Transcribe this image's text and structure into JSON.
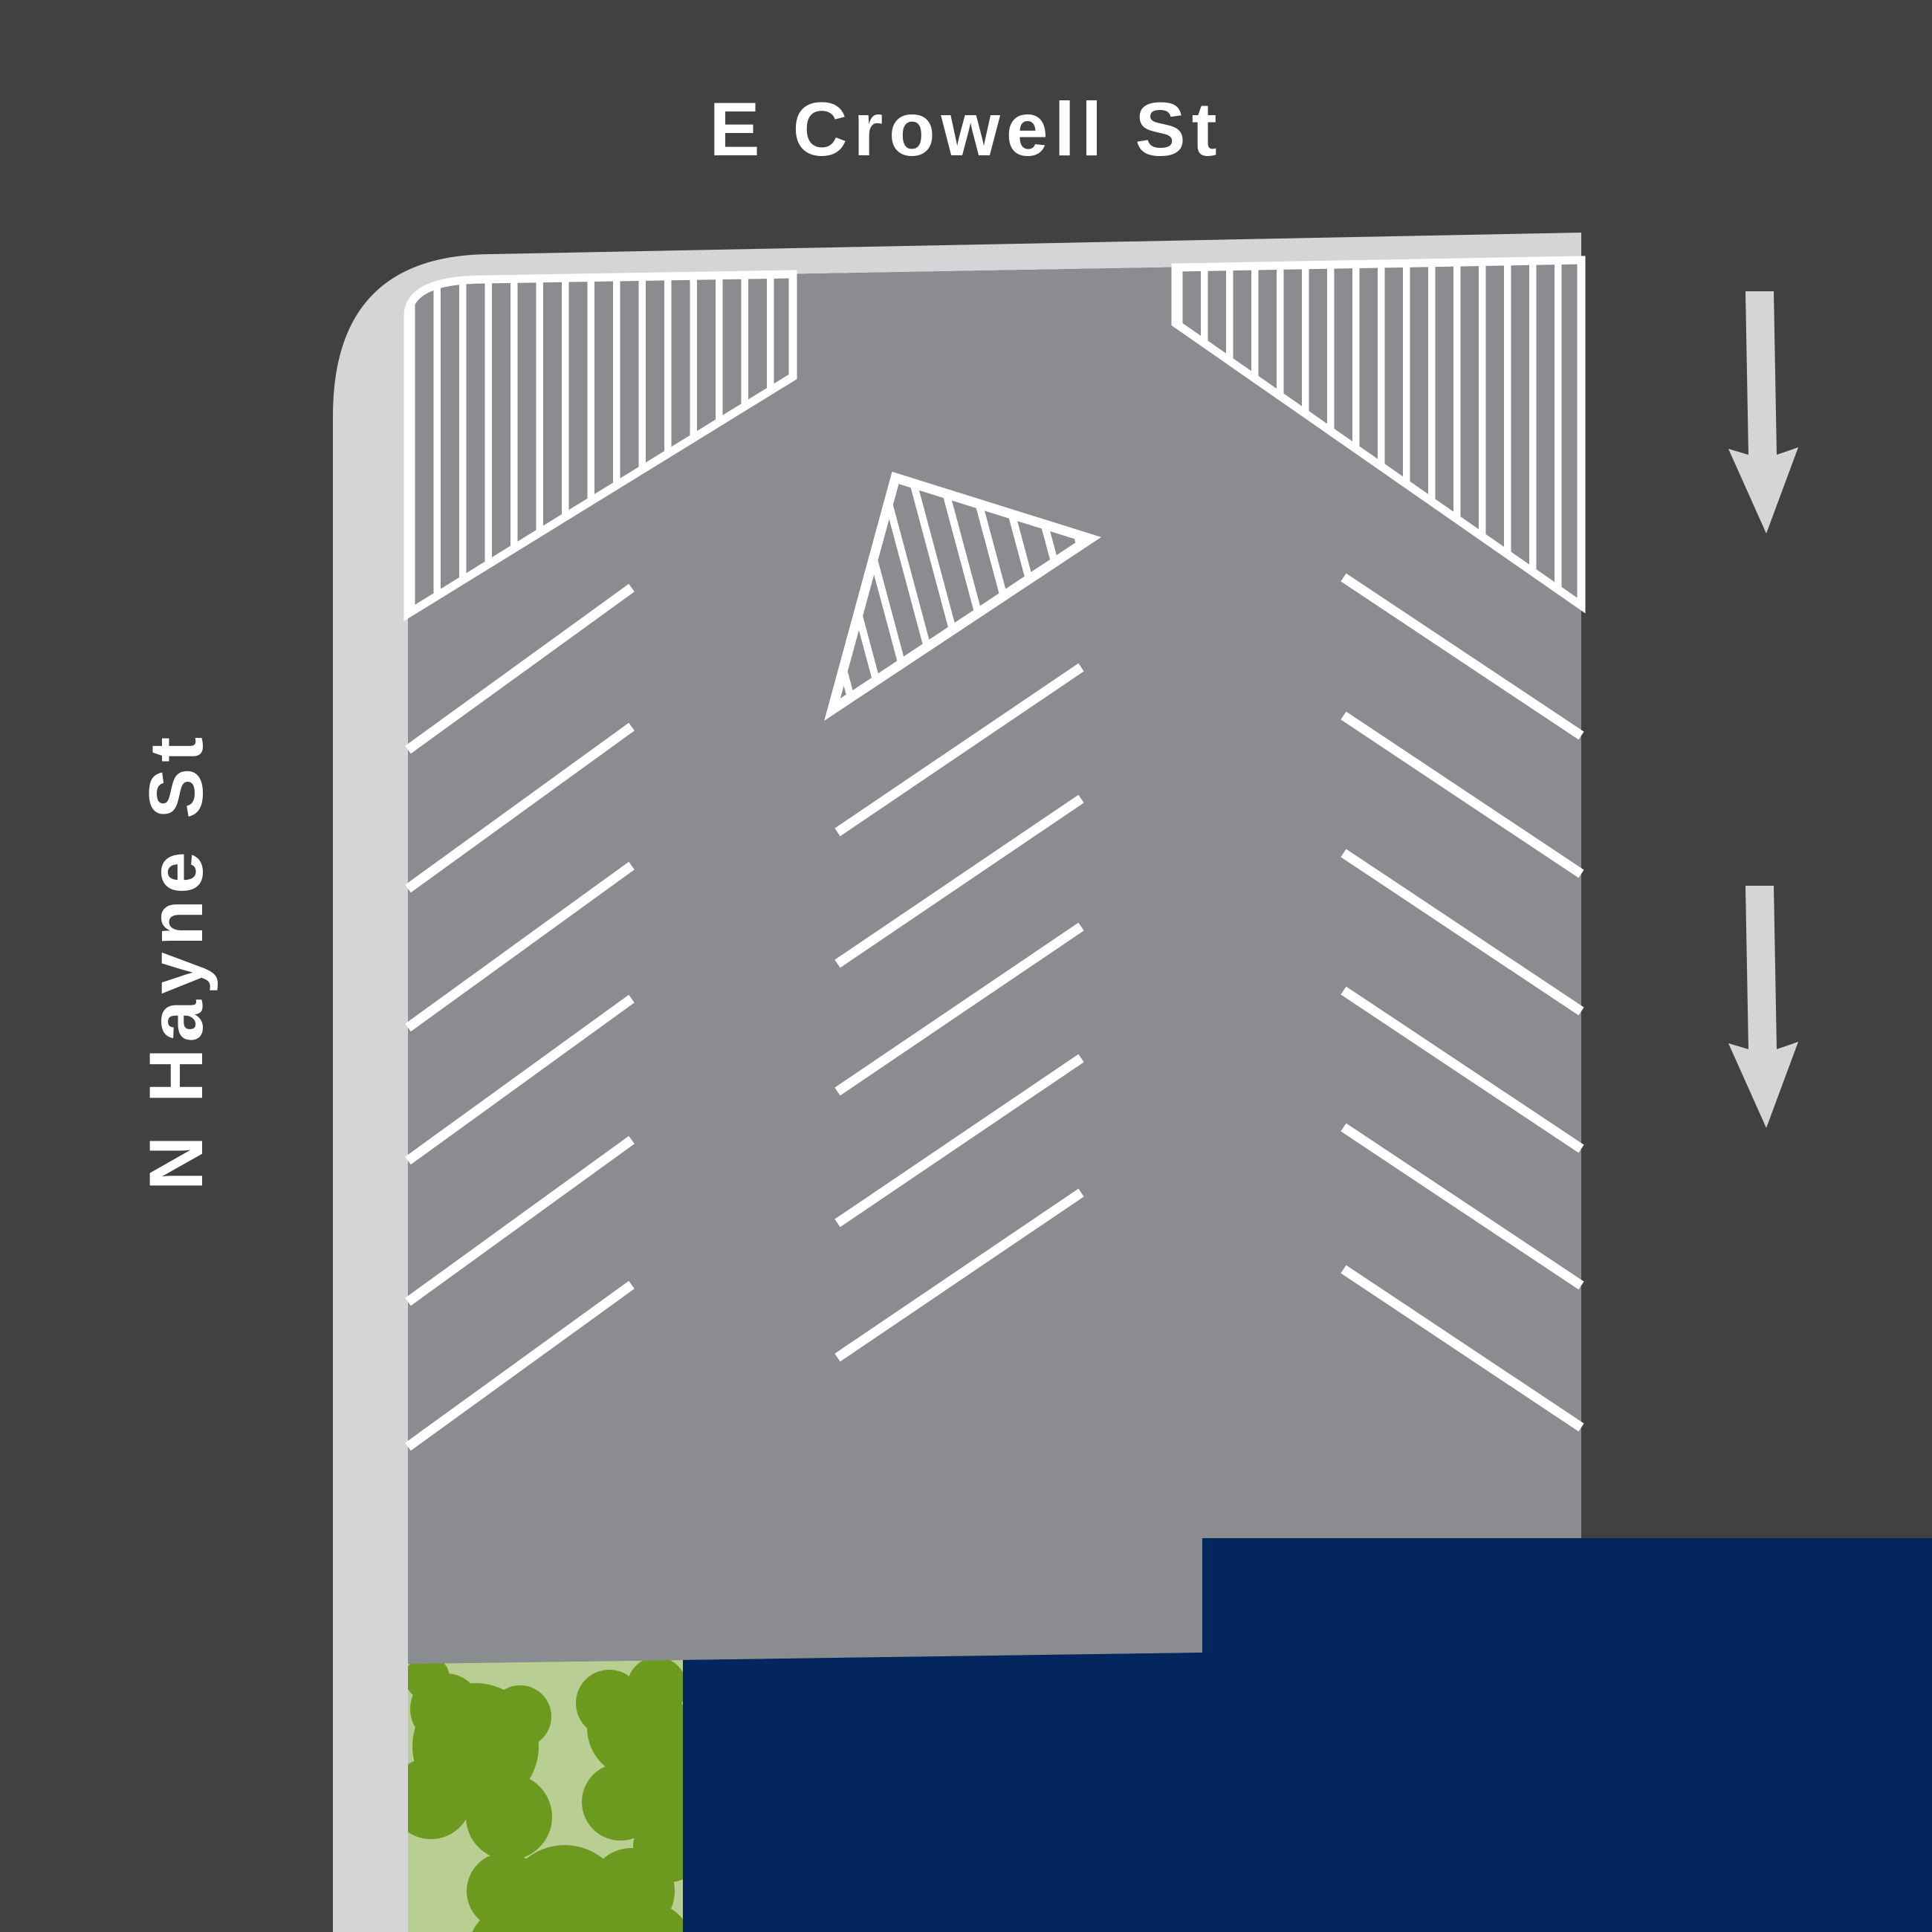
{
  "map": {
    "streets": {
      "top": {
        "label": "E Crowell St"
      },
      "left": {
        "label": "N Hayne St"
      }
    },
    "traffic_arrows": {
      "count": 2,
      "direction": "down"
    },
    "parking": {
      "left_row_line_count": 6,
      "center_row_line_count": 5,
      "right_row_line_count": 6,
      "hatched_zone_count": 3,
      "island_shape": "triangle"
    },
    "colors": {
      "street": "#414143",
      "asphalt": "#8A8C8F",
      "sidewalk": "#D4D5D7",
      "marking": "#FFFFFF",
      "building": "#03265F",
      "grass": "#B9CE93",
      "bush": "#6B9A1E",
      "arrow": "#D4D5D7"
    }
  }
}
